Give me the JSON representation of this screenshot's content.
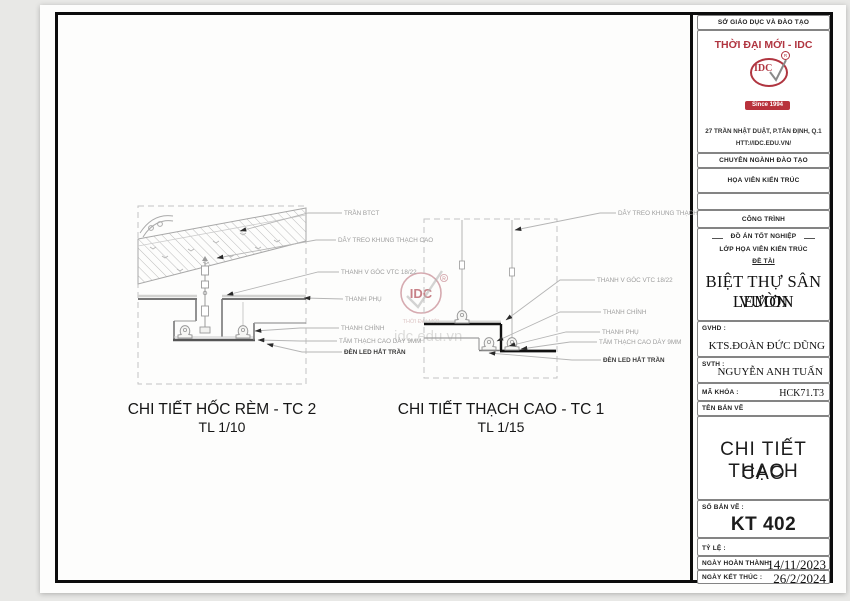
{
  "watermark": {
    "logo_text": "IDC",
    "registered": "R",
    "brand": "THỜI ĐẠI MỚI",
    "url": "idc.edu.vn"
  },
  "drawings": {
    "tc2": {
      "title": "CHI TIẾT HỐC RÈM - TC 2",
      "scale": "TL 1/10",
      "labels": [
        "TRẦN BTCT",
        "DÂY TREO KHUNG THẠCH CAO",
        "THANH V GÓC VTC 18/22",
        "THANH PHỤ",
        "THANH CHÍNH",
        "TẤM THẠCH CAO DÀY 9MM",
        "ĐÈN LED HẮT TRẦN"
      ]
    },
    "tc1": {
      "title": "CHI TIẾT THẠCH CAO - TC 1",
      "scale": "TL 1/15",
      "labels": [
        "DÂY TREO KHUNG THẠCH CAO",
        "THANH V GÓC VTC 18/22",
        "THANH CHÍNH",
        "THANH PHỤ",
        "TẤM THẠCH CAO DÀY 9MM",
        "ĐÈN LED HẮT TRẦN"
      ]
    }
  },
  "title_block": {
    "department": "SỞ GIÁO DỤC VÀ ĐÀO TẠO",
    "company": "THỜI ĐẠI MỚI - IDC",
    "logo_text": "IDC",
    "logo_since": "Since 1994",
    "address": "27 TRẦN NHẬT DUẬT, P.TÂN ĐỊNH, Q.1",
    "website": "HTT://IDC.EDU.VN/",
    "major_header": "CHUYÊN NGÀNH ĐÀO TẠO",
    "major": "HỌA VIÊN KIẾN TRÚC",
    "project_header": "CÔNG TRÌNH",
    "project_type": "ĐỒ ÁN TỐT NGHIỆP",
    "class_name": "LỚP HỌA VIÊN KIẾN TRÚC",
    "topic_label": "ĐỀ TÀI",
    "topic_line1": "BIỆT THỰ SÂN VƯỜN",
    "topic_line2": "LEMON",
    "gvhd_label": "GVHD :",
    "gvhd_value": "KTS.ĐOÀN ĐỨC DŨNG",
    "svth_label": "SVTH :",
    "svth_value": "NGUYỄN ANH TUẤN",
    "code_label": "MÃ KHÓA :",
    "code_value": "HCK71.T3",
    "sheet_name_label": "TÊN BẢN VẼ",
    "sheet_name_line1": "CHI TIẾT THẠCH",
    "sheet_name_line2": "CAO",
    "sheet_no_label": "SỐ BẢN VẼ :",
    "sheet_no_value": "KT 402",
    "scale_label": "TỶ LỆ :",
    "finish_label": "NGÀY HOÀN THÀNH:",
    "finish_date": "14/11/2023",
    "end_label": "NGÀY KẾT THÚC :",
    "end_date": "26/2/2024",
    "accent_red": "#b03540"
  }
}
